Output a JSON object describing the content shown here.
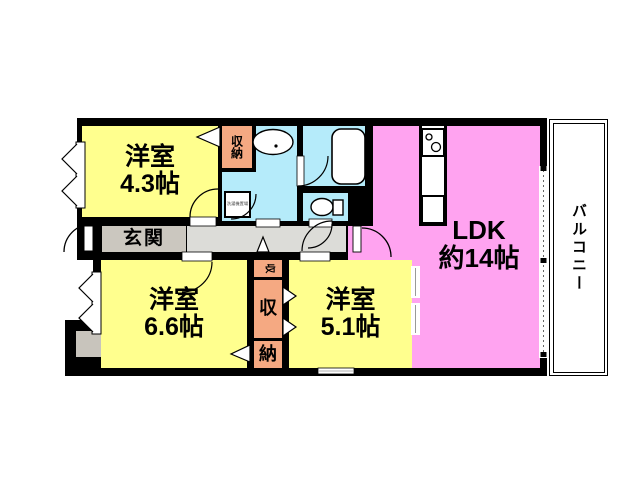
{
  "plan": {
    "type": "floor-plan",
    "rooms": {
      "room43": {
        "name": "洋室",
        "size": "4.3帖"
      },
      "room66": {
        "name": "洋室",
        "size": "6.6帖"
      },
      "room51": {
        "name": "洋室",
        "size": "5.1帖"
      },
      "ldk": {
        "name": "LDK",
        "size": "約14帖"
      },
      "entrance": {
        "label": "玄関"
      },
      "closet_top": {
        "label": "収納"
      },
      "closet_mid": {
        "small": "収",
        "upper": "収",
        "lower": "納"
      },
      "balcony": {
        "label": "バルコニー"
      },
      "washer": {
        "label": "洗濯機置場"
      }
    },
    "fixtures": [
      "bathtub-icon",
      "toilet-icon",
      "wash-basin-icon",
      "stove-icon",
      "kitchen-sink-icon",
      "washing-machine-pan"
    ],
    "colors": {
      "room_yellow": "#FFFF8E",
      "ldk_pink": "#FFA3F0",
      "closet_salmon": "#F5A982",
      "wet_blue": "#B5EBFA",
      "entrance_gray": "#CBC7BF",
      "hallway_gray": "#DCDCD8",
      "pillar_gray": "#C8C4BC",
      "wall_black": "#000000"
    }
  }
}
